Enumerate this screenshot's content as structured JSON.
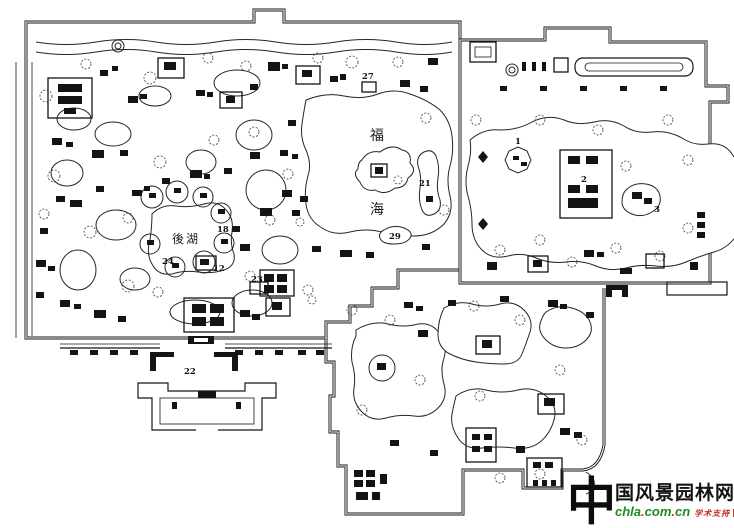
{
  "page": {
    "background": "#ffffff",
    "ink": "#161616"
  },
  "map": {
    "lakes": {
      "fuhai_char1": "福",
      "fuhai_char2": "海",
      "houhu": "後湖"
    },
    "site_numbers": {
      "n1": "1",
      "n2": "2",
      "n3": "3",
      "n12": "12",
      "n18": "18",
      "n21": "21",
      "n22": "22",
      "n23": "23",
      "n24": "24",
      "n27": "27",
      "n29": "29"
    }
  },
  "watermark": {
    "logo_char": "中",
    "name_rest": "国风景园林网",
    "url": {
      "part1": "chla",
      "dot1": ".",
      "part2": "com",
      "dot2": ".",
      "part3": "cn"
    },
    "tagline": "学术支持",
    "colors": {
      "url_green": "#1f8a1f",
      "accent_red": "#d03020",
      "ink": "#111111"
    }
  }
}
